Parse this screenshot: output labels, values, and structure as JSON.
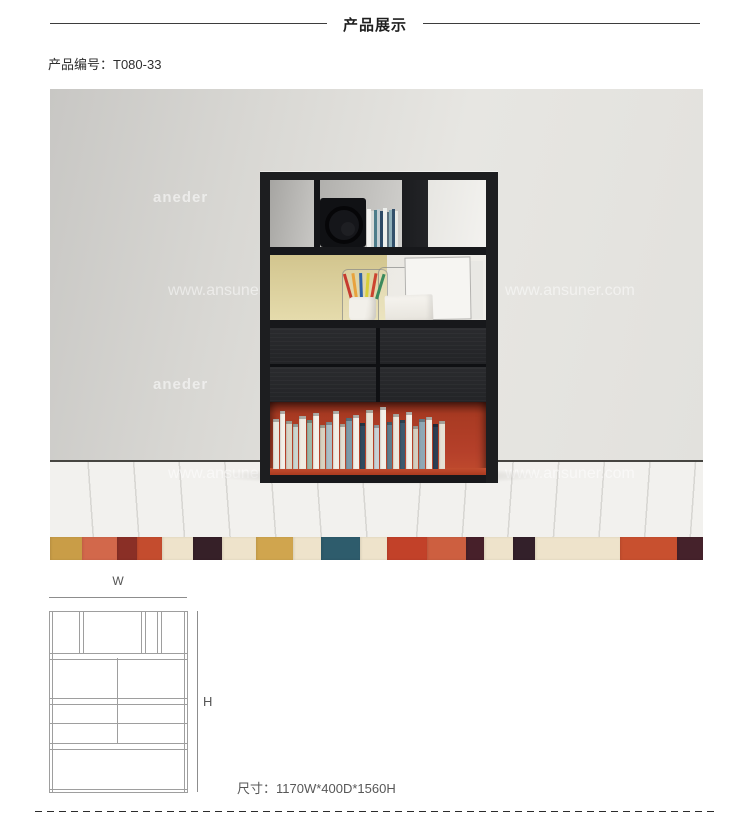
{
  "header": {
    "title": "产品展示"
  },
  "product": {
    "code": "产品编号：T080-33"
  },
  "photo": {
    "watermark_brand": "aneder",
    "watermark_url": "www.ansuner.com",
    "colors": {
      "wall": "#dcdbd7",
      "floor": "#f2f1ee",
      "shelf_black": "#1d1e20",
      "back_panel_yellow": "#ddd2a2",
      "compartment_red": "#b5402a"
    },
    "rug_stripes": [
      {
        "color": "#c99d47",
        "width": 32
      },
      {
        "color": "#d2684b",
        "width": 35
      },
      {
        "color": "#8a2f26",
        "width": 20
      },
      {
        "color": "#c44c2e",
        "width": 25
      },
      {
        "color": "#eee3cb",
        "width": 31
      },
      {
        "color": "#362028",
        "width": 29
      },
      {
        "color": "#eee3cb",
        "width": 34
      },
      {
        "color": "#d0a54e",
        "width": 37
      },
      {
        "color": "#eee3cb",
        "width": 28
      },
      {
        "color": "#2e5c6c",
        "width": 39
      },
      {
        "color": "#eee3cb",
        "width": 27
      },
      {
        "color": "#c24129",
        "width": 40
      },
      {
        "color": "#cd5f40",
        "width": 39
      },
      {
        "color": "#47202a",
        "width": 18
      },
      {
        "color": "#eee3cb",
        "width": 29
      },
      {
        "color": "#33202a",
        "width": 22
      },
      {
        "color": "#eee3cb",
        "width": 85
      },
      {
        "color": "#c8502f",
        "width": 57
      },
      {
        "color": "#45222b",
        "width": 26
      }
    ],
    "book_spines": [
      {
        "color": "#e9e6dd",
        "width": 6,
        "height": 50
      },
      {
        "color": "#f2efe7",
        "width": 5,
        "height": 58
      },
      {
        "color": "#d9d5c6",
        "width": 6,
        "height": 48
      },
      {
        "color": "#cbd6d0",
        "width": 5,
        "height": 45
      },
      {
        "color": "#f0ece2",
        "width": 7,
        "height": 53
      },
      {
        "color": "#9fb9a8",
        "width": 5,
        "height": 49
      },
      {
        "color": "#f4f1e9",
        "width": 6,
        "height": 56
      },
      {
        "color": "#d8d2c0",
        "width": 5,
        "height": 44
      },
      {
        "color": "#aebfc6",
        "width": 6,
        "height": 47
      },
      {
        "color": "#f1eee6",
        "width": 6,
        "height": 58
      },
      {
        "color": "#e4dfd2",
        "width": 5,
        "height": 45
      },
      {
        "color": "#7e9aa8",
        "width": 6,
        "height": 51
      },
      {
        "color": "#f3f0e8",
        "width": 6,
        "height": 54
      },
      {
        "color": "#2f4a5e",
        "width": 5,
        "height": 46
      },
      {
        "color": "#e9e4d6",
        "width": 7,
        "height": 59
      },
      {
        "color": "#c8d2d6",
        "width": 5,
        "height": 44
      },
      {
        "color": "#f2efe7",
        "width": 6,
        "height": 62
      },
      {
        "color": "#5f7d8c",
        "width": 5,
        "height": 47
      },
      {
        "color": "#ece8dd",
        "width": 6,
        "height": 55
      },
      {
        "color": "#3d5a6e",
        "width": 5,
        "height": 49
      },
      {
        "color": "#f4f1e9",
        "width": 6,
        "height": 57
      },
      {
        "color": "#d5cfc0",
        "width": 5,
        "height": 43
      },
      {
        "color": "#8fa8b5",
        "width": 6,
        "height": 50
      },
      {
        "color": "#f0ede5",
        "width": 6,
        "height": 52
      },
      {
        "color": "#2c3d52",
        "width": 5,
        "height": 45
      },
      {
        "color": "#e6e1d4",
        "width": 6,
        "height": 48
      }
    ],
    "cd_spines": [
      {
        "color": "#f2f2ef",
        "width": 4,
        "height": 38
      },
      {
        "color": "#d8dbd8",
        "width": 3,
        "height": 36
      },
      {
        "color": "#4d7d8a",
        "width": 3,
        "height": 37
      },
      {
        "color": "#c3ced2",
        "width": 3,
        "height": 38
      },
      {
        "color": "#2d4a66",
        "width": 3,
        "height": 36
      },
      {
        "color": "#eef0ed",
        "width": 4,
        "height": 39
      },
      {
        "color": "#5a6f7d",
        "width": 2,
        "height": 35
      },
      {
        "color": "#8fb0ba",
        "width": 3,
        "height": 37
      },
      {
        "color": "#32506b",
        "width": 3,
        "height": 38
      },
      {
        "color": "#e8eae6",
        "width": 3,
        "height": 36
      }
    ],
    "pencil_colors": [
      {
        "color": "#c63b2e",
        "tilt": -16
      },
      {
        "color": "#e8a23c",
        "tilt": -8
      },
      {
        "color": "#2f62a8",
        "tilt": -2
      },
      {
        "color": "#d8cf3a",
        "tilt": 4
      },
      {
        "color": "#cc4430",
        "tilt": 10
      },
      {
        "color": "#3b8a5d",
        "tilt": 17
      }
    ]
  },
  "diagram": {
    "width_label": "W",
    "height_label": "H",
    "size_text": "尺寸：1170W*400D*1560H"
  }
}
